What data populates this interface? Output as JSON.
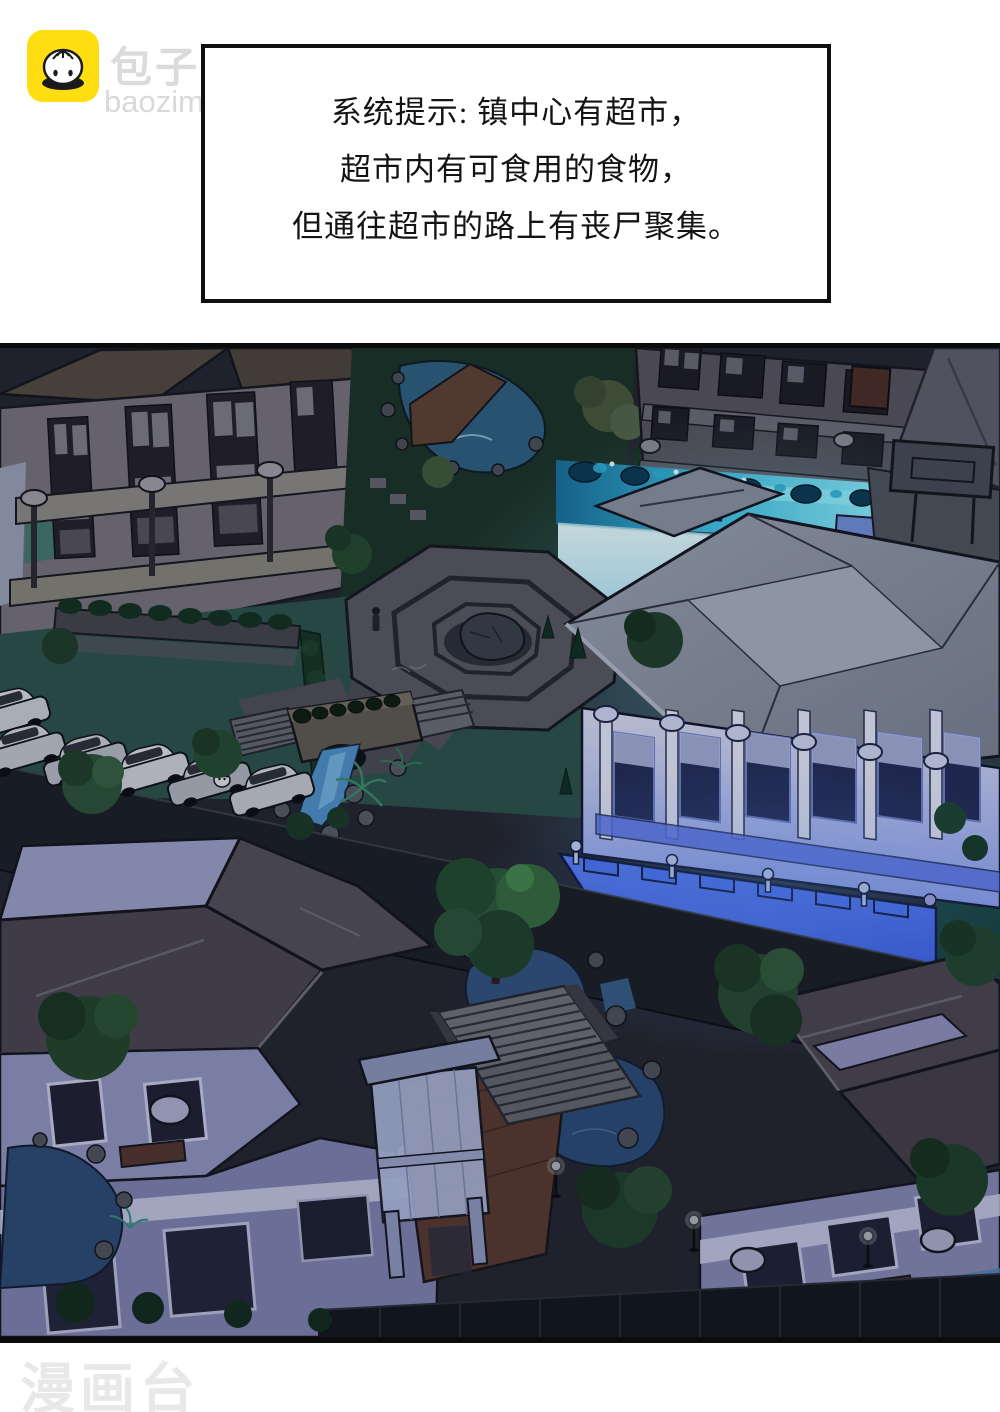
{
  "header": {
    "brand": "包子漫畫",
    "site": "baozimh.com",
    "logo_bg": "#FFDE11"
  },
  "dialog": {
    "line1": "系统提示: 镇中心有超市，",
    "line2": "超市内有可食用的食物，",
    "line3": "但通往超市的路上有丧尸聚集。"
  },
  "footer": {
    "watermark": "漫画台"
  },
  "scene": {
    "palette": {
      "night_bg": "#23262E",
      "road": "#1A1E25",
      "lawn": "#2B5248",
      "glow_cyan": "#8FF0FD",
      "highlight_blue": "#4A73F5",
      "roof_dark": "#49454F",
      "roof_stone": "#A6ADBA",
      "wall_lavender": "#8F92BD",
      "facade_beige": "#76727A",
      "tree_green": "#2C5A38",
      "pond_blue": "#31517E",
      "stream_blue": "#4F8FC8",
      "car_silver": "#BFC3CB"
    }
  }
}
